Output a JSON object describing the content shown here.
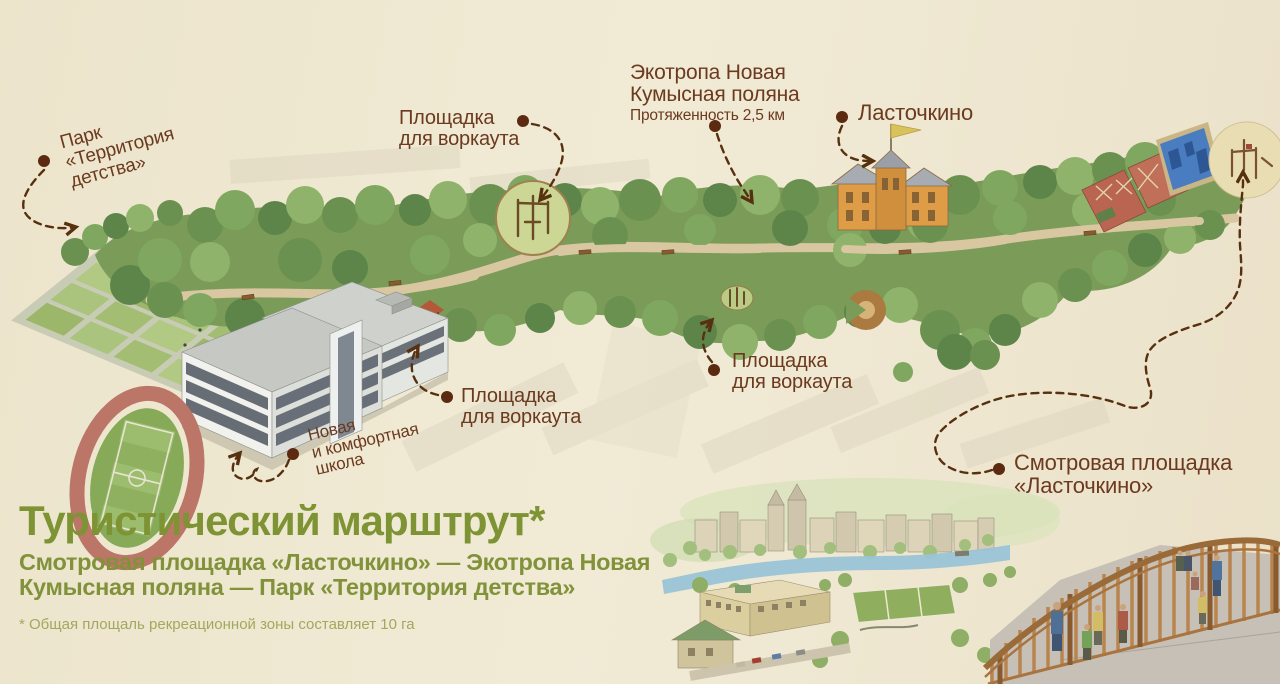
{
  "colors": {
    "background": "#ece4cb",
    "title_green": "#7d9334",
    "label_brown": "#6b3a1f",
    "route_dash_brown": "#57300f",
    "forest_green": "#7a9c58",
    "stadium_track": "#bb7668"
  },
  "labels": {
    "park": {
      "lines": [
        "Парк",
        "«Территория",
        "детства»"
      ]
    },
    "workout_top": {
      "lines": [
        "Площадка",
        "для воркаута"
      ]
    },
    "ecotrail": {
      "lines": [
        "Экотропа Новая",
        "Кумысная поляна"
      ],
      "note": "Протяженность 2,5 км"
    },
    "lastochkino": {
      "lines": [
        "Ласточкино"
      ]
    },
    "workout_left": {
      "lines": [
        "Площадка",
        "для воркаута"
      ]
    },
    "workout_mid": {
      "lines": [
        "Площадка",
        "для воркаута"
      ]
    },
    "school": {
      "lines": [
        "Новая",
        "и комфортная",
        "школа"
      ]
    },
    "viewpoint": {
      "lines": [
        "Смотровая площадка",
        "«Ласточкино»"
      ]
    }
  },
  "title_block": {
    "title": "Туристический марштрут*",
    "subtitle_lines": [
      "Смотровая площадка «Ласточкино» — Экотропа Новая",
      "Кумысная поляна — Парк «Территория детства»"
    ],
    "footnote": "* Общая площаль рекреационной зоны составляет 10 га"
  }
}
